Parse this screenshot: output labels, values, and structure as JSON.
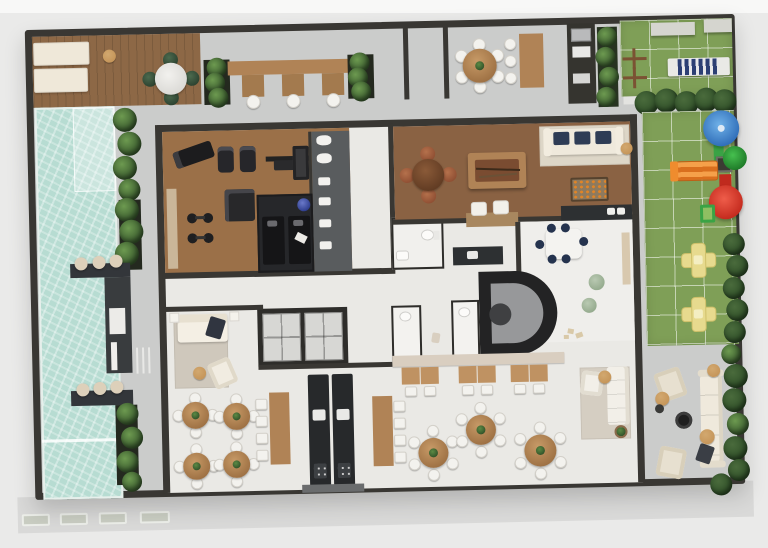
{
  "palette": {
    "bg": "#eaeae9",
    "band": "#f8f8f7",
    "sidewalk": "#d9d9d8",
    "wall": "#393733",
    "concrete": "#cbcccb",
    "tile": "#eae9e5",
    "wood_deck": "#8d6846",
    "wood_gym": "#9b7048",
    "wood_game": "#8a6243",
    "wood_table": "#b08356",
    "pool": "#b7dcd2",
    "grass": "#7f9f57",
    "hedge": "#2f4f28",
    "plant": "#4a7a3c",
    "cream": "#efe9dc",
    "white": "#f3f2ee",
    "navy": "#2e3c55",
    "tan": "#c59559",
    "rug": "#d5cec2",
    "dark_room": "#26272a",
    "counter": "#2d3032",
    "sage": "#a4b89d",
    "felt": "#7a4c31",
    "play_yellow": "#e7da8e",
    "play_orange": "#ef8c2e",
    "play_red": "#d5352a",
    "play_blue": "#3f87d4",
    "play_green": "#3aa345",
    "beige": "#ddd0ba",
    "steel": "#9fa2a3"
  },
  "scene": {
    "type": "architectural-floor-plan-3d-render",
    "areas": [
      {
        "name": "sun-deck",
        "items": [
          "2 sun loungers",
          "round side table",
          "dining table with 4 green chairs"
        ]
      },
      {
        "name": "swimming-pool",
        "items": [
          "tanning ledge",
          "lap lane line",
          "2 swim-up counters with 3 stools each",
          "edge planters"
        ]
      },
      {
        "name": "outdoor-bar",
        "items": [
          "bar counter",
          "3 white stools",
          "2 planter boxes"
        ]
      },
      {
        "name": "outdoor-dining-north",
        "items": [
          "round table with 6 white chairs",
          "high table with 3 stools",
          "grill counter",
          "green wall"
        ]
      },
      {
        "name": "lawn-terrace",
        "items": [
          "2 benches",
          "blue striped double lounger",
          "2 wood fitness frames"
        ]
      },
      {
        "name": "playground",
        "items": [
          "blue dome canopy",
          "orange slide",
          "red cone tower",
          "green ladder",
          "palm",
          "2 yellow cross play pads",
          "hedge"
        ]
      },
      {
        "name": "gym",
        "items": [
          "treadmill",
          "2 exercise bikes",
          "bench press rack",
          "multi-gym machine",
          "2 dumbbell sets",
          "shelf"
        ]
      },
      {
        "name": "massage-room",
        "items": [
          "2 massage beds",
          "blue exercise ball",
          "towel"
        ]
      },
      {
        "name": "locker-room",
        "items": [
          "2 toilets",
          "4 sinks"
        ]
      },
      {
        "name": "game-room",
        "items": [
          "billiard table with cues",
          "card table with 4 chairs",
          "foosball table",
          "sofa with 3 navy cushions",
          "console with 2 poufs",
          "kitchenette counter"
        ]
      },
      {
        "name": "kids-playroom",
        "items": [
          "kids table with 6 navy stools",
          "2 sage poufs",
          "wall shelf",
          "toys"
        ]
      },
      {
        "name": "lobby",
        "items": [
          "2 elevators",
          "spiral stair",
          "2 wc rooms",
          "service counter",
          "bathroom"
        ]
      },
      {
        "name": "reading-lounge",
        "items": [
          "sofa with throw",
          "armchair",
          "rug",
          "side table"
        ]
      },
      {
        "name": "cafe-corner",
        "items": [
          "4 round tables with 4 chairs each"
        ]
      },
      {
        "name": "party-room",
        "items": [
          "double kitchen island with sinks and cooktops",
          "2 long tables with 4 chairs each",
          "3 pair-table sets",
          "buffet sideboard",
          "3 round tables with 6 chairs",
          "lounge rug with sofa",
          "planter"
        ]
      },
      {
        "name": "outdoor-lounge",
        "items": [
          "outdoor sofa",
          "2 wicker armchairs",
          "fire pit",
          "3 side tables",
          "green wall"
        ]
      },
      {
        "name": "sidewalk",
        "items": [
          "4 pavement benches"
        ]
      }
    ]
  }
}
